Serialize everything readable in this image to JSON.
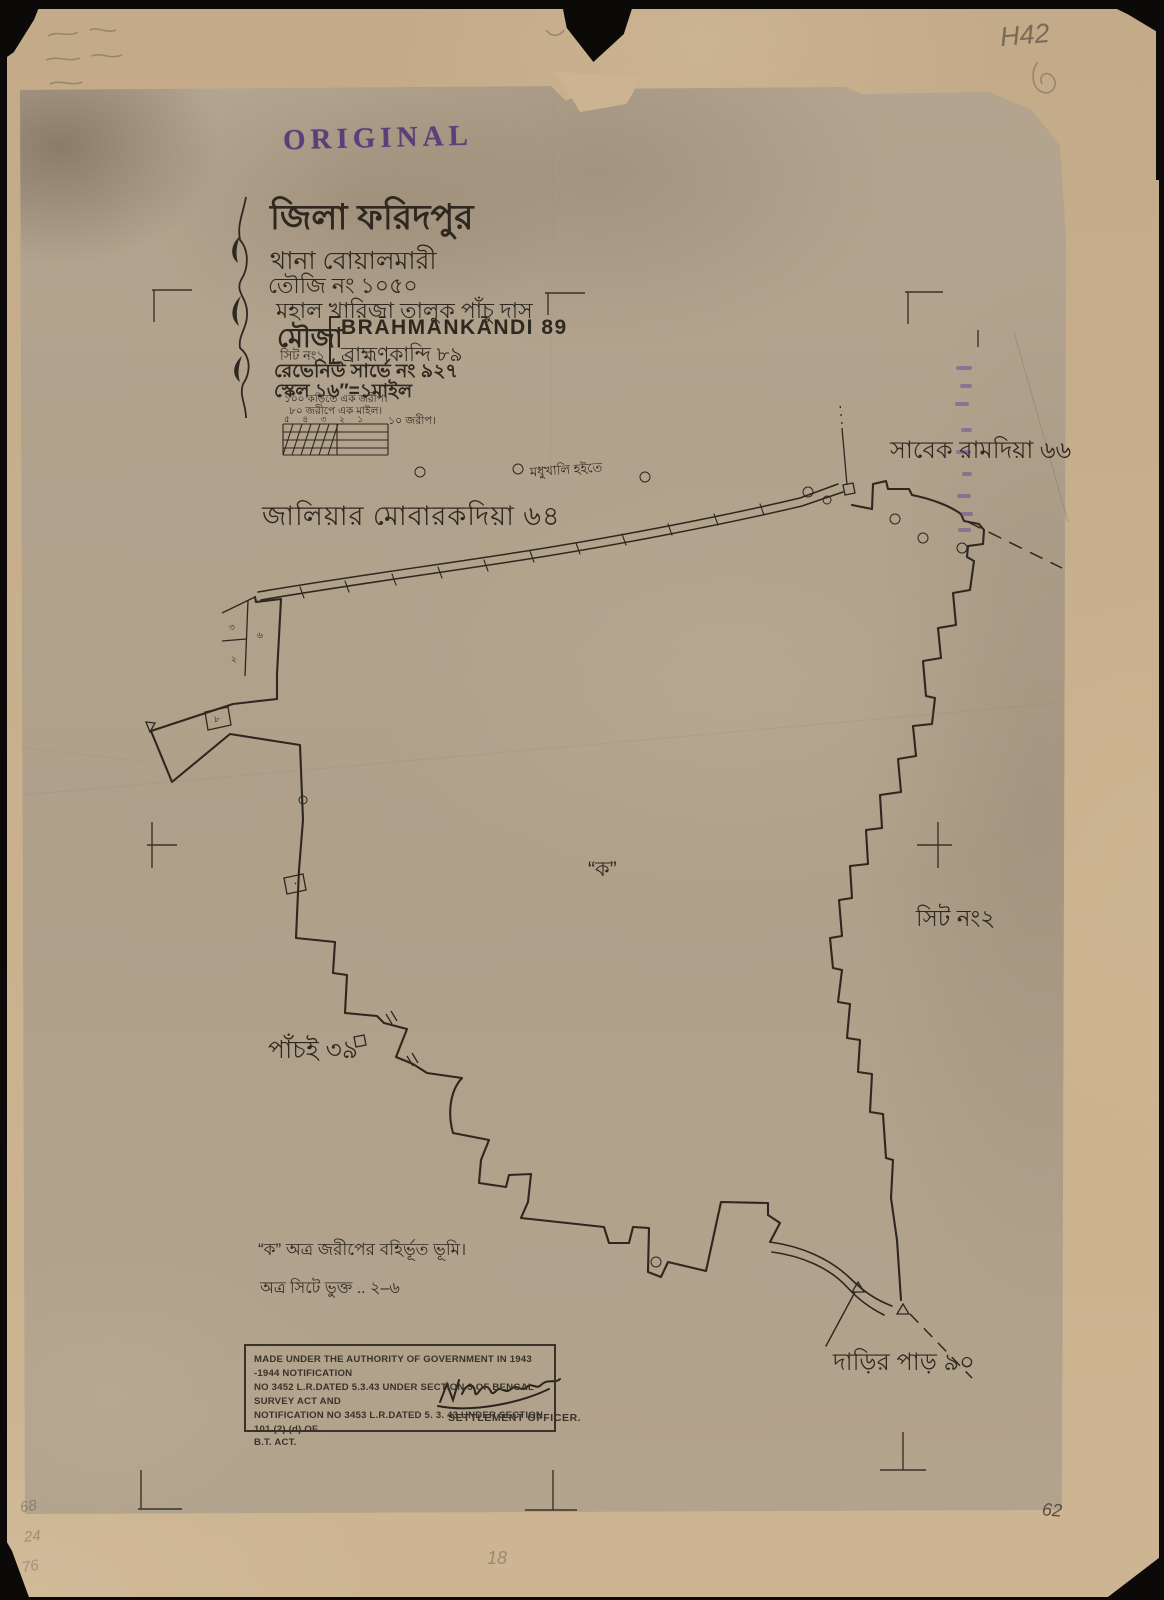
{
  "stamps": {
    "original": "ORIGINAL",
    "authority_line1": "MADE UNDER THE AUTHORITY OF GOVERNMENT IN 1943 -1944 NOTIFICATION",
    "authority_line2": "NO 3452 L.R.DATED 5.3.43  UNDER SECTION 3 OF BENGAL SURVEY ACT AND",
    "authority_line3": "NOTIFICATION NO 3453 L.R.DATED 5. 3. 43  UNDER SECTION 101 (2) (d) OF",
    "authority_line4": "B.T. ACT.",
    "signatory": "SETTLEMENT OFFICER."
  },
  "title_block": {
    "district": "জিলা ফরিদপুর",
    "thana": "থানা  বোয়ালমারী",
    "touzi": "তৌজি নং ১০৫০",
    "mahal": "মহাল  খারিজা তালুক পাঁচু দাস",
    "mouza_label": "মৌজা",
    "sheet_no": "সিট নং১",
    "mouza_en": "BRĀHMANKĀNDI 89",
    "mouza_bn": "ব্রাহ্মণকান্দি ৮৯",
    "revenue_survey": "রেভেনিউ সার্ভে নং ৯২৭",
    "scale": "স্কেল ১৬″=১মাইল",
    "scale_note1": "১০০ কড়িতে এক জরীপ।",
    "scale_note2": "৮০ জরীপে এক মাইল।",
    "scale_bar_numbers": "৫ ৪ ৩ ২ ১",
    "scale_bar_unit": "১০ জরীপ।"
  },
  "map_labels": {
    "neighbor_nw": "জালিয়ার মোবারকদিয়া ৬৪",
    "neighbor_ne": "সাবেক রামদিয়া ৬৬",
    "road_from": "মধুখালি হইতে",
    "center_mark": "“ক”",
    "sheet2": "সিট নং২",
    "neighbor_sw": "পাঁচই ৩৯",
    "neighbor_se": "দাড়ির পাড় ৯০"
  },
  "plot_numbers": {
    "cell_top": "৩",
    "cell_bottom": "২",
    "cell_right": "৬",
    "wedge_cell": "৮"
  },
  "notes": {
    "line1": "“ক”  অত্র জরীপের বহির্ভূত ভূমি।",
    "line2": "অত্র সিটে ভুক্ত ..  ২–৬"
  },
  "pencil": {
    "top_right": "H42",
    "bottom_mid": "18",
    "bottom_right": "62",
    "bottom_left_1": "68",
    "bottom_left_2": "24",
    "bottom_left_3": "76"
  }
}
